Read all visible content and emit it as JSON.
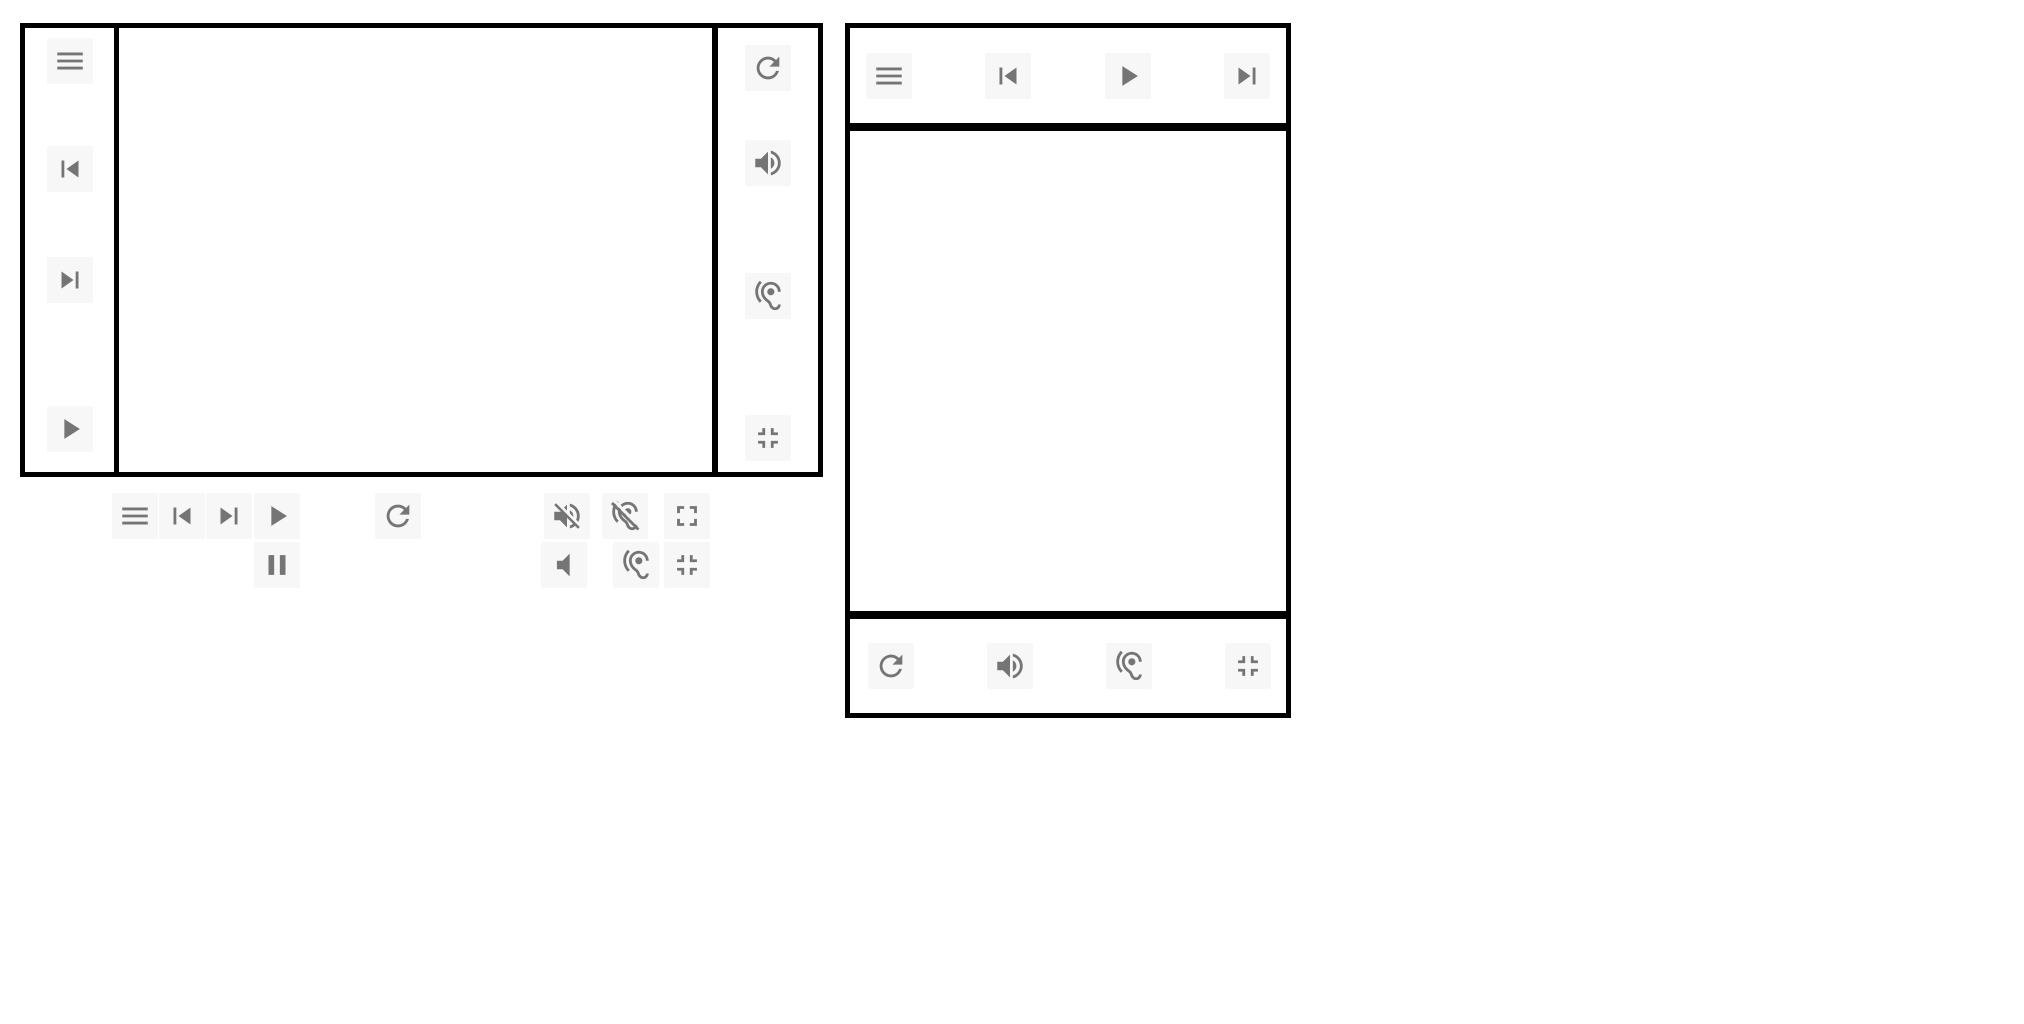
{
  "app": {
    "kind": "media-player-ui-mock",
    "visible_text": ""
  },
  "colors": {
    "canvas_bg": "#ffffff",
    "panel_bg": "#ffffff",
    "panel_border": "#000000",
    "icon_glyph": "#757575",
    "icon_chip_bg": "#f7f7f7"
  },
  "left_player": {
    "nav_rail": {
      "icons": [
        "menu",
        "skip-previous",
        "skip-next",
        "play"
      ]
    },
    "side_rail": {
      "icons": [
        "refresh",
        "volume-up",
        "hearing",
        "fullscreen-exit"
      ]
    }
  },
  "toolbar": {
    "row1": [
      "menu",
      "skip-previous",
      "skip-next",
      "play",
      "refresh",
      "volume-off",
      "hearing-disabled",
      "fullscreen"
    ],
    "row2": [
      "pause",
      "volume-mute",
      "hearing",
      "fullscreen-exit"
    ]
  },
  "right_player": {
    "top_bar": {
      "icons": [
        "menu",
        "skip-previous",
        "play",
        "skip-next"
      ]
    },
    "bottom_bar": {
      "icons": [
        "refresh",
        "volume-up",
        "hearing",
        "fullscreen-exit"
      ]
    }
  }
}
